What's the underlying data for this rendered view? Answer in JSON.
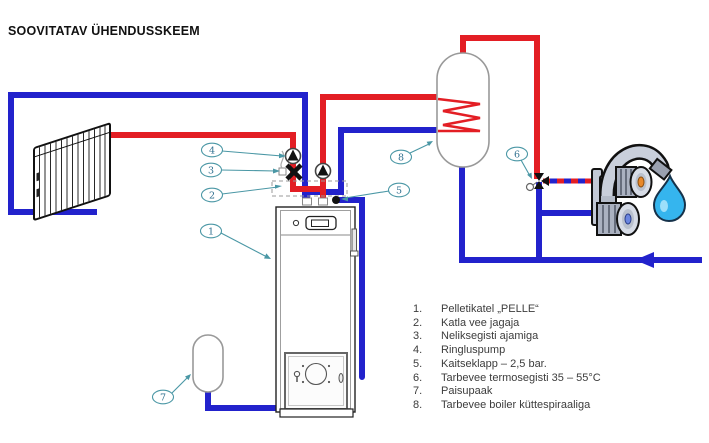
{
  "title": "SOOVITATAV ÜHENDUSSKEEM",
  "colors": {
    "hot": "#e31e24",
    "cold": "#2222cc",
    "callout": "#4a97a5",
    "callout_text": "#2f6f8f",
    "drop_fill": "#35b5ee",
    "drop_highlight": "#aee6fb",
    "knob_hot": "#e8882a",
    "knob_cold": "#6b86e0"
  },
  "callouts": {
    "labels": [
      "1",
      "2",
      "3",
      "4",
      "5",
      "6",
      "7",
      "8"
    ]
  },
  "legend": {
    "items": [
      {
        "num": "1.",
        "text": "Pelletikatel „PELLE“"
      },
      {
        "num": "2.",
        "text": "Katla vee jagaja"
      },
      {
        "num": "3.",
        "text": "Neliksegisti ajamiga"
      },
      {
        "num": "4.",
        "text": "Ringluspump"
      },
      {
        "num": "5.",
        "text": "Kaitseklapp – 2,5 bar."
      },
      {
        "num": "6.",
        "text": "Tarbevee termosegisti 35 – 55°C"
      },
      {
        "num": "7.",
        "text": "Paisupaak"
      },
      {
        "num": "8.",
        "text": "Tarbevee boiler küttespiraaliga"
      }
    ]
  }
}
